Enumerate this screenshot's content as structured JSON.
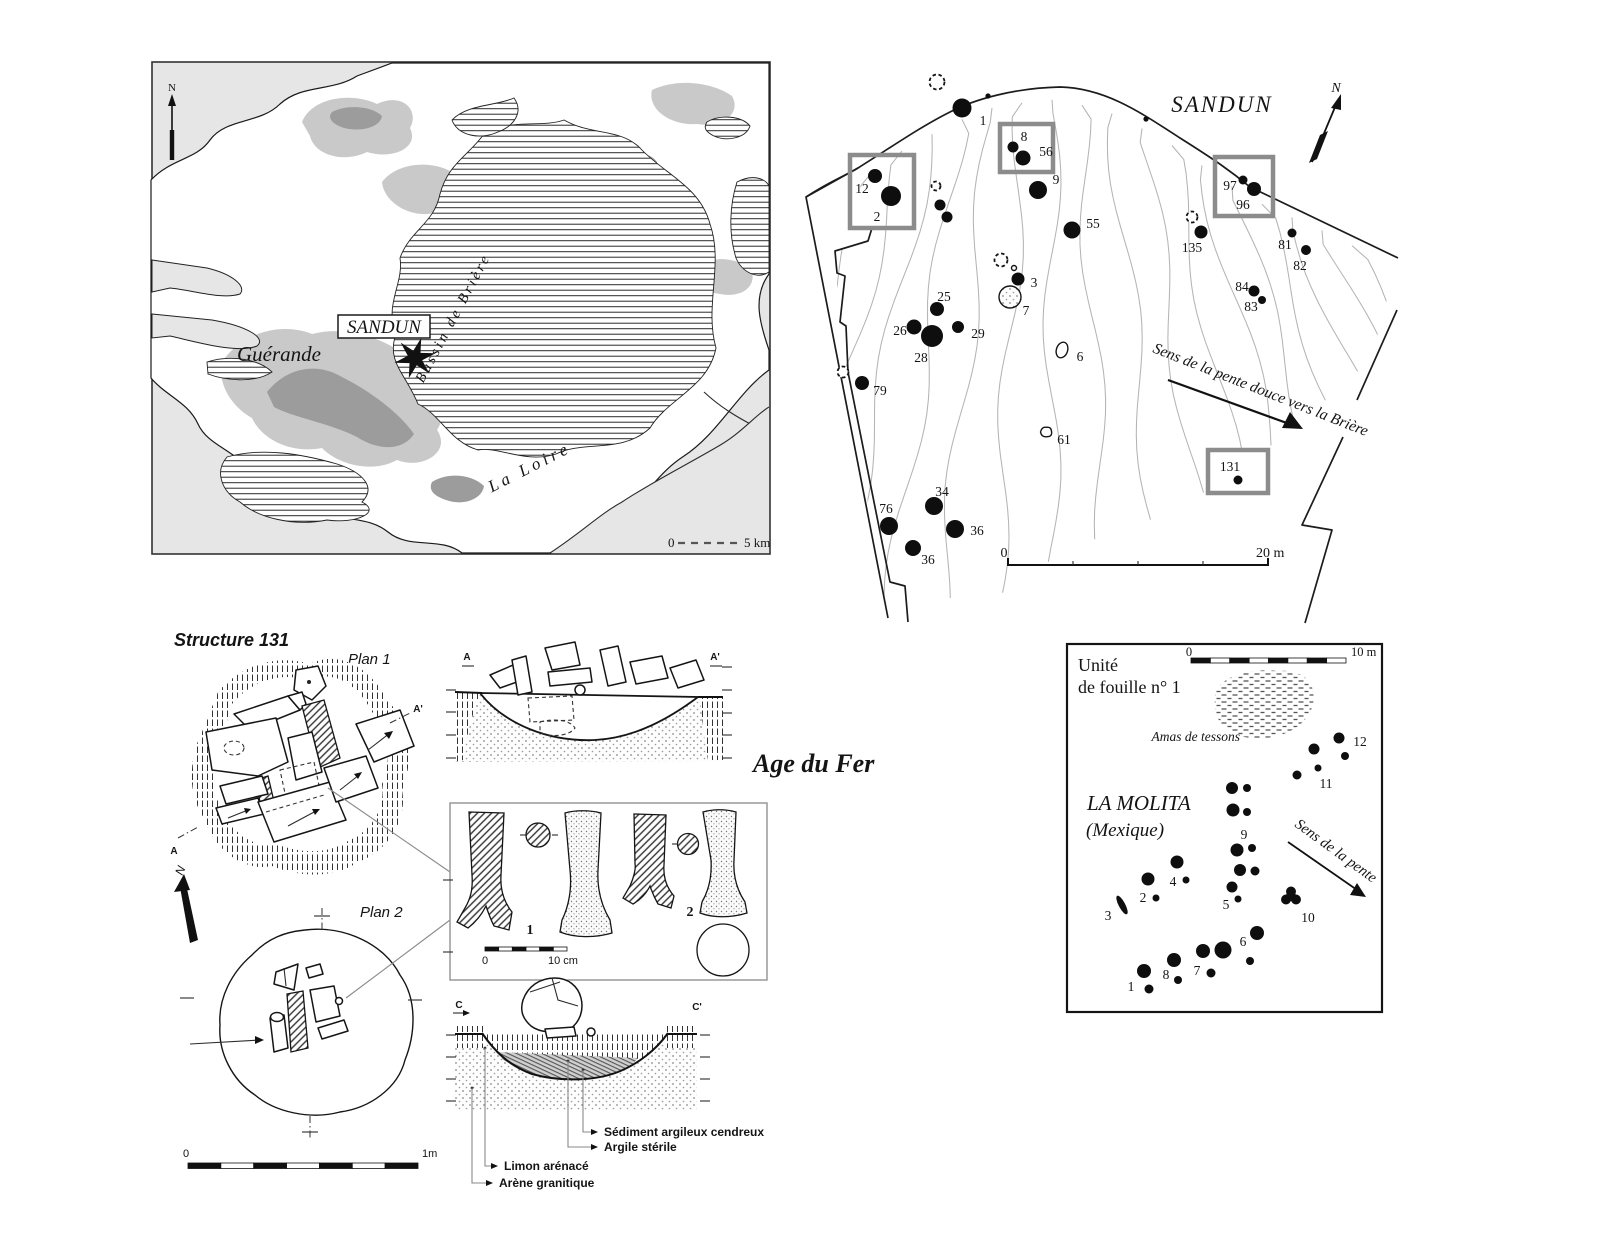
{
  "region_map": {
    "north_label": "N",
    "site_label": "SANDUN",
    "town_label": "Guérande",
    "basin_label": "Bassin de Brière",
    "river_label": "La Loire",
    "scale_start": "0",
    "scale_end": "5 km"
  },
  "site_plan": {
    "title": "SANDUN",
    "north_label": "N",
    "slope_label": "Sens de la pente douce vers la Brière",
    "scale_start": "0",
    "scale_end": "20 m",
    "highlight_boxes": [
      {
        "x": 850,
        "y": 155,
        "w": 64,
        "h": 73
      },
      {
        "x": 1000,
        "y": 124,
        "w": 53,
        "h": 48
      },
      {
        "x": 1215,
        "y": 157,
        "w": 58,
        "h": 59
      },
      {
        "x": 1208,
        "y": 450,
        "w": 60,
        "h": 43,
        "fill": "#ffffff"
      }
    ],
    "features": [
      {
        "n": "1",
        "x": 962,
        "y": 108,
        "r": 9.5,
        "lx": 983,
        "ly": 125
      },
      {
        "n": "12",
        "x": 875,
        "y": 176,
        "r": 7,
        "lx": 862,
        "ly": 193
      },
      {
        "n": "2",
        "x": 891,
        "y": 196,
        "r": 10,
        "lx": 877,
        "ly": 221
      },
      {
        "n": "8",
        "x": 1013,
        "y": 147,
        "r": 5.5,
        "lx": 1024,
        "ly": 141
      },
      {
        "n": "56",
        "x": 1023,
        "y": 158,
        "r": 7.5,
        "lx": 1046,
        "ly": 156
      },
      {
        "n": "9",
        "x": 1038,
        "y": 190,
        "r": 9,
        "lx": 1056,
        "ly": 184
      },
      {
        "x": 940,
        "y": 205,
        "r": 5.5
      },
      {
        "x": 947,
        "y": 217,
        "r": 5.5
      },
      {
        "n": "55",
        "x": 1072,
        "y": 230,
        "r": 8.5,
        "lx": 1093,
        "ly": 228
      },
      {
        "n": "135",
        "x": 1201,
        "y": 232,
        "r": 6.5,
        "lx": 1192,
        "ly": 252
      },
      {
        "n": "97",
        "x": 1243,
        "y": 180,
        "r": 4.5,
        "lx": 1230,
        "ly": 190
      },
      {
        "n": "96",
        "x": 1254,
        "y": 189,
        "r": 7,
        "lx": 1243,
        "ly": 209
      },
      {
        "n": "81",
        "x": 1292,
        "y": 233,
        "r": 4.5,
        "lx": 1285,
        "ly": 249
      },
      {
        "n": "82",
        "x": 1306,
        "y": 250,
        "r": 5,
        "lx": 1300,
        "ly": 270
      },
      {
        "n": "84",
        "x": 1254,
        "y": 291,
        "r": 5.5,
        "lx": 1242,
        "ly": 291
      },
      {
        "n": "83",
        "x": 1262,
        "y": 300,
        "r": 4,
        "lx": 1251,
        "ly": 311
      },
      {
        "n": "25",
        "x": 937,
        "y": 309,
        "r": 7,
        "lx": 944,
        "ly": 301
      },
      {
        "n": "26",
        "x": 914,
        "y": 327,
        "r": 7.5,
        "lx": 900,
        "ly": 335
      },
      {
        "n": "29",
        "x": 958,
        "y": 327,
        "r": 6,
        "lx": 978,
        "ly": 338
      },
      {
        "n": "28",
        "x": 932,
        "y": 336,
        "r": 11,
        "lx": 921,
        "ly": 362
      },
      {
        "n": "3",
        "x": 1018,
        "y": 279,
        "r": 6.5,
        "lx": 1034,
        "ly": 287
      },
      {
        "n": "79",
        "x": 862,
        "y": 383,
        "r": 7,
        "lx": 880,
        "ly": 395
      },
      {
        "n": "34",
        "x": 934,
        "y": 506,
        "r": 9,
        "lx": 942,
        "ly": 496
      },
      {
        "n": "76",
        "x": 889,
        "y": 526,
        "r": 9,
        "lx": 886,
        "ly": 513
      },
      {
        "n": "36",
        "x": 955,
        "y": 529,
        "r": 9,
        "lx": 977,
        "ly": 535
      },
      {
        "n": "36",
        "x": 913,
        "y": 548,
        "r": 8,
        "lx": 928,
        "ly": 564
      },
      {
        "n": "131",
        "x": 1238,
        "y": 480,
        "r": 4.5,
        "lx": 1230,
        "ly": 471
      }
    ],
    "open_features": [
      {
        "x": 937,
        "y": 82,
        "r": 7.5,
        "style": "dashed"
      },
      {
        "x": 936,
        "y": 186,
        "r": 4.5,
        "style": "dashed"
      },
      {
        "x": 1192,
        "y": 217,
        "r": 5.5,
        "style": "dashed"
      },
      {
        "x": 1001,
        "y": 260,
        "r": 6.5,
        "style": "dashed"
      },
      {
        "x": 1014,
        "y": 268,
        "r": 2.5,
        "style": "open"
      },
      {
        "x": 843,
        "y": 372,
        "r": 5.5,
        "style": "dashed"
      },
      {
        "n": "7",
        "x": 1010,
        "y": 297,
        "r": 11,
        "style": "stippled",
        "lx": 1026,
        "ly": 315
      },
      {
        "n": "6",
        "x": 1062,
        "y": 350,
        "r": 8,
        "style": "oval",
        "lx": 1080,
        "ly": 361
      },
      {
        "n": "61",
        "x": 1046,
        "y": 432,
        "r": 5.5,
        "style": "irregular",
        "lx": 1064,
        "ly": 444
      }
    ]
  },
  "structure131": {
    "title": "Structure 131",
    "plan1_label": "Plan 1",
    "plan2_label": "Plan 2",
    "north_label": "N",
    "period_label": "Age du Fer",
    "section_a": "A",
    "section_a_prime": "A'",
    "section_c": "C",
    "section_c_prime": "C'",
    "artifact_1": "1",
    "artifact_2": "2",
    "artifact_scale_start": "0",
    "artifact_scale_end": "10 cm",
    "plan_scale_start": "0",
    "plan_scale_end": "1m",
    "legend": [
      "Sédiment argileux cendreux",
      "Argile stérile",
      "Limon arénacé",
      "Arène granitique"
    ]
  },
  "molita": {
    "unit_label_line1": "Unité",
    "unit_label_line2": "de fouille n° 1",
    "site_label_line1": "LA MOLITA",
    "site_label_line2": "(Mexique)",
    "sherds_label": "Amas de tessons",
    "slope_label": "Sens de la pente",
    "scale_start": "0",
    "scale_end": "10 m",
    "features": [
      {
        "n": "12",
        "x": 1339,
        "y": 738,
        "r": 5.5,
        "lx": 1360,
        "ly": 746
      },
      {
        "x": 1314,
        "y": 749,
        "r": 5.5
      },
      {
        "x": 1345,
        "y": 756,
        "r": 4
      },
      {
        "n": "11",
        "x": 1318,
        "y": 768,
        "r": 3.5,
        "lx": 1326,
        "ly": 788
      },
      {
        "x": 1297,
        "y": 775,
        "r": 4.5
      },
      {
        "x": 1232,
        "y": 788,
        "r": 6
      },
      {
        "x": 1247,
        "y": 788,
        "r": 4
      },
      {
        "x": 1233,
        "y": 810,
        "r": 6.5
      },
      {
        "x": 1247,
        "y": 812,
        "r": 4
      },
      {
        "n": "9",
        "x": 1237,
        "y": 850,
        "r": 6.5,
        "lx": 1244,
        "ly": 839
      },
      {
        "x": 1252,
        "y": 848,
        "r": 4
      },
      {
        "x": 1240,
        "y": 870,
        "r": 6
      },
      {
        "x": 1255,
        "y": 871,
        "r": 4.5
      },
      {
        "n": "4",
        "x": 1177,
        "y": 862,
        "r": 6.5,
        "lx": 1173,
        "ly": 886
      },
      {
        "x": 1186,
        "y": 880,
        "r": 3.5
      },
      {
        "n": "2",
        "x": 1148,
        "y": 879,
        "r": 6.5,
        "lx": 1143,
        "ly": 902
      },
      {
        "x": 1156,
        "y": 898,
        "r": 3.5
      },
      {
        "n": "3",
        "x": 1122,
        "y": 905,
        "r": 6.5,
        "style": "blob3",
        "lx": 1108,
        "ly": 920
      },
      {
        "n": "5",
        "x": 1232,
        "y": 887,
        "r": 5.5,
        "lx": 1226,
        "ly": 909
      },
      {
        "x": 1238,
        "y": 899,
        "r": 3.5
      },
      {
        "n": "10",
        "x": 1291,
        "y": 896,
        "r": 8,
        "style": "blobY",
        "lx": 1308,
        "ly": 922
      },
      {
        "n": "6",
        "x": 1257,
        "y": 933,
        "r": 7,
        "lx": 1243,
        "ly": 946
      },
      {
        "x": 1250,
        "y": 961,
        "r": 4
      },
      {
        "n": "7",
        "x": 1203,
        "y": 951,
        "r": 7,
        "lx": 1197,
        "ly": 975
      },
      {
        "x": 1223,
        "y": 950,
        "r": 8.5
      },
      {
        "x": 1211,
        "y": 973,
        "r": 4.5
      },
      {
        "n": "8",
        "x": 1174,
        "y": 960,
        "r": 7,
        "lx": 1166,
        "ly": 979
      },
      {
        "x": 1178,
        "y": 980,
        "r": 4
      },
      {
        "n": "1",
        "x": 1144,
        "y": 971,
        "r": 7,
        "lx": 1131,
        "ly": 991
      },
      {
        "x": 1149,
        "y": 989,
        "r": 4.5
      }
    ]
  },
  "colors": {
    "highlight_box": "#8c8c8c",
    "contour": "#b4b4b4",
    "ink": "#141414",
    "map_light_gray": "#c9c9c9",
    "map_dark_gray": "#9c9c9c",
    "map_sea": "#e6e6e6"
  }
}
